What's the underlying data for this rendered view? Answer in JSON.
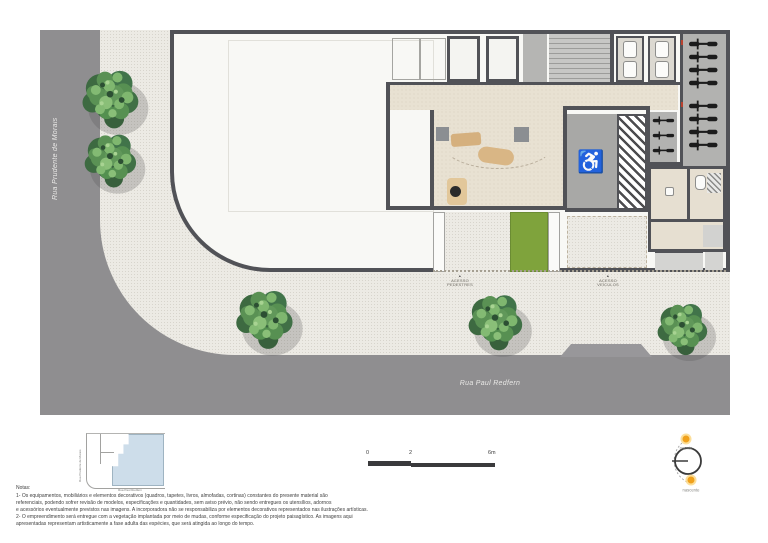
{
  "plan": {
    "street_left": "Rua Prudente de Morais",
    "street_bottom": "Rua Paul Redfern",
    "pedestrian_access": {
      "line1": "ACESSO",
      "line2": "PEDESTRES"
    },
    "vehicle_access": {
      "line1": "ACESSO",
      "line2": "VEÍCULOS"
    }
  },
  "icons": {
    "wheelchair": "♿",
    "arrow_up": "▲"
  },
  "key_plan": {
    "street_left": "Rua Prudente de Morais",
    "street_bottom": "Rua Paul Redfern"
  },
  "notes": {
    "title": "Notas:",
    "lines": [
      "1- Os equipamentos, mobiliários e elementos decorativos (quadros, tapetes, livros, almofadas, cortinas) constantes do presente material são",
      "referenciais, podendo sofrer revisão de modelos, especificações e quantidades, sem aviso prévio, não sendo entregues os utensílios, adornos",
      "e acessórios eventualmente previstos nas imagens. A incorporadora não se responsabiliza por elementos decorativos representados nas ilustrações artísticas.",
      "2- O empreendimento será entregue com a vegetação implantada por meio de mudas, conforme especificação do projeto paisagístico. As imagens aqui",
      "apresentadas representam artisticamente a fase adulta das espécies, que será atingida ao longo do tempo."
    ]
  },
  "scale_bar": {
    "ticks": [
      "0",
      "2",
      "6m"
    ]
  },
  "compass": {
    "sunset_label": "poente",
    "sunrise_label": "nascente"
  },
  "colors": {
    "street": "#8f8e90",
    "sidewalk": "#eceae4",
    "floor_beige": "#e8e1d2",
    "wall": "#515257",
    "grass": "#7fa33c",
    "key_plan_fill": "#cdddea",
    "sun": "#f0a11c"
  }
}
